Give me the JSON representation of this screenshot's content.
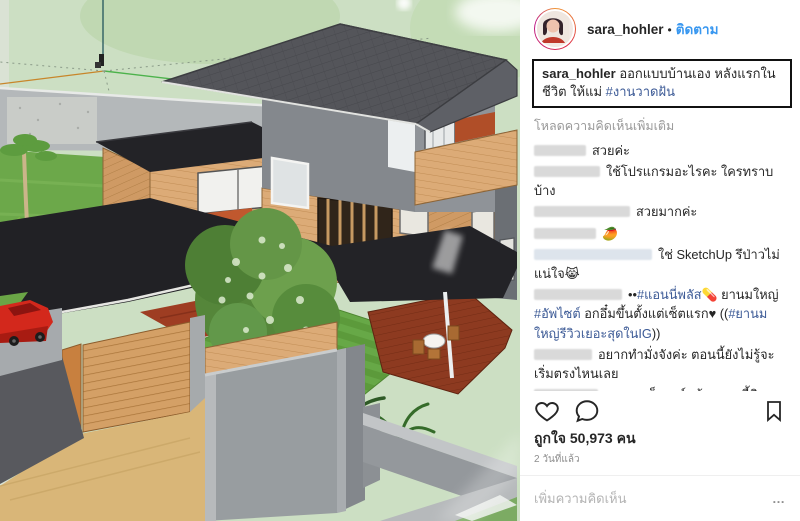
{
  "header": {
    "username": "sara_hohler",
    "separator": "•",
    "follow_label": "ติดตาม"
  },
  "caption": {
    "username": "sara_hohler",
    "text": " ออกแบบบ้านเอง หลังแรกในชีวิต ให้แม่ ",
    "hashtag": "#งานวาดฝัน"
  },
  "load_more_label": "โหลดความคิดเห็นเพิ่มเติม",
  "comments": [
    {
      "text": "สวยค่ะ"
    },
    {
      "text": "ใช้โปรแกรมอะไรคะ ใครทราบบ้าง"
    },
    {
      "text": "สวยมากค่ะ"
    },
    {
      "text": "🥭"
    },
    {
      "text": "ใช่ SketchUp รึป่าวไม่แน่ใจ",
      "emoji": "😹"
    },
    {
      "lead": "••",
      "tag1": "#แอนนี่พลัส",
      "emoji1": "💊",
      "t1": " ยานมใหญ่ ",
      "tag2": "#อัพไซต์",
      "t2": " อกอึ๋มขึ้นตั้งแต่เซ็ตแรก♥ ((",
      "tag3": "#ยานมใหญ่รีวิวเยอะสุดในIG",
      "t3": "))"
    },
    {
      "text": "อยากทำมั่งจังค่ะ ตอนนี้ยังไม่รู้จะเริ่มตรงไหนเลย"
    },
    {
      "text": "สวยๆๆ เด็กอาร์ทต้องแบบนี้สิ"
    },
    {
      "text": "ยอมใจ",
      "emoji": "👌"
    },
    {
      "text": "😊😊"
    }
  ],
  "stats": {
    "likes_label": "ถูกใจ 50,973 คน",
    "timestamp": "2 วันที่แล้ว"
  },
  "composer": {
    "placeholder": "เพิ่มความคิดเห็น",
    "more_options": "…"
  },
  "photo": {
    "alt": "Photo of a screen showing a SketchUp 3D model of a two-storey wood-and-grey house with hip roof, black flat canopies, garden tree, red deck with dining set, concrete fence, tan driveway and red car"
  },
  "colors": {
    "follow_blue": "#3897f0",
    "hashtag_blue": "#3c5a96",
    "text_dark": "#262626",
    "muted_gray": "#8e8e8e",
    "sketchup_sky_green": "#ccdfc3",
    "roof_gray": "#54555a",
    "wood_tan": "#d9a772",
    "canopy_black": "#232327",
    "lawn_green": "#5c9a3b",
    "deck_red": "#8d3a20",
    "accent_orange": "#c0582e",
    "car_red": "#d3281c"
  }
}
